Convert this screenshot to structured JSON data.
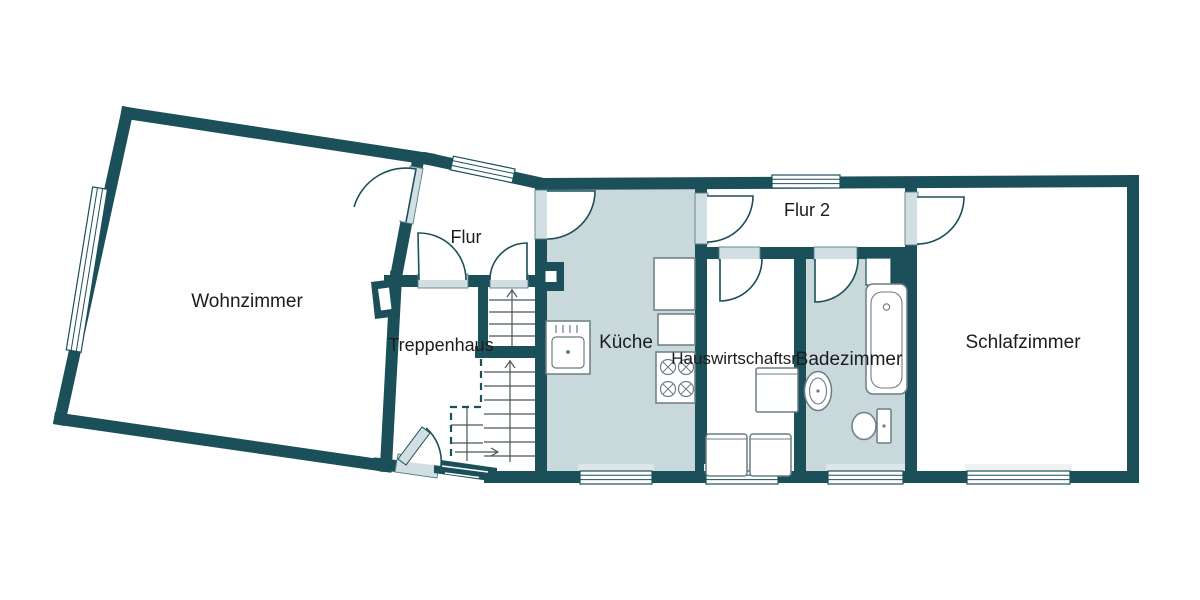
{
  "plan": {
    "background": "#ffffff",
    "wall_color": "#1b4f59",
    "shaded_room_color": "#c9d8db",
    "door_sill_color": "#d2dfe2",
    "window_sill_color": "#dce6e8",
    "fixture_stroke": "#6b7e84",
    "stair_line_color": "#4a565a",
    "text_color": "#1c1c1c"
  },
  "rooms": {
    "wohnzimmer": {
      "label": "Wohnzimmer",
      "shaded": false
    },
    "flur": {
      "label": "Flur",
      "shaded": false
    },
    "treppenhaus": {
      "label": "Treppenhaus",
      "shaded": false
    },
    "kueche": {
      "label": "Küche",
      "shaded": true
    },
    "flur2": {
      "label": "Flur 2",
      "shaded": false
    },
    "hauswirtschaftsraum": {
      "label": "Hauswirtschaftsr.",
      "shaded": false
    },
    "badezimmer": {
      "label": "Badezimmer",
      "shaded": true
    },
    "schlafzimmer": {
      "label": "Schlafzimmer",
      "shaded": false
    }
  },
  "fixtures": [
    "kitchen-sink",
    "stove",
    "refrigerator",
    "kitchen-counter",
    "washer",
    "dryer",
    "utility-appliance",
    "bathtub",
    "bathroom-sink",
    "toilet",
    "stairs",
    "entrance-door",
    "windows",
    "doors",
    "chimney"
  ]
}
